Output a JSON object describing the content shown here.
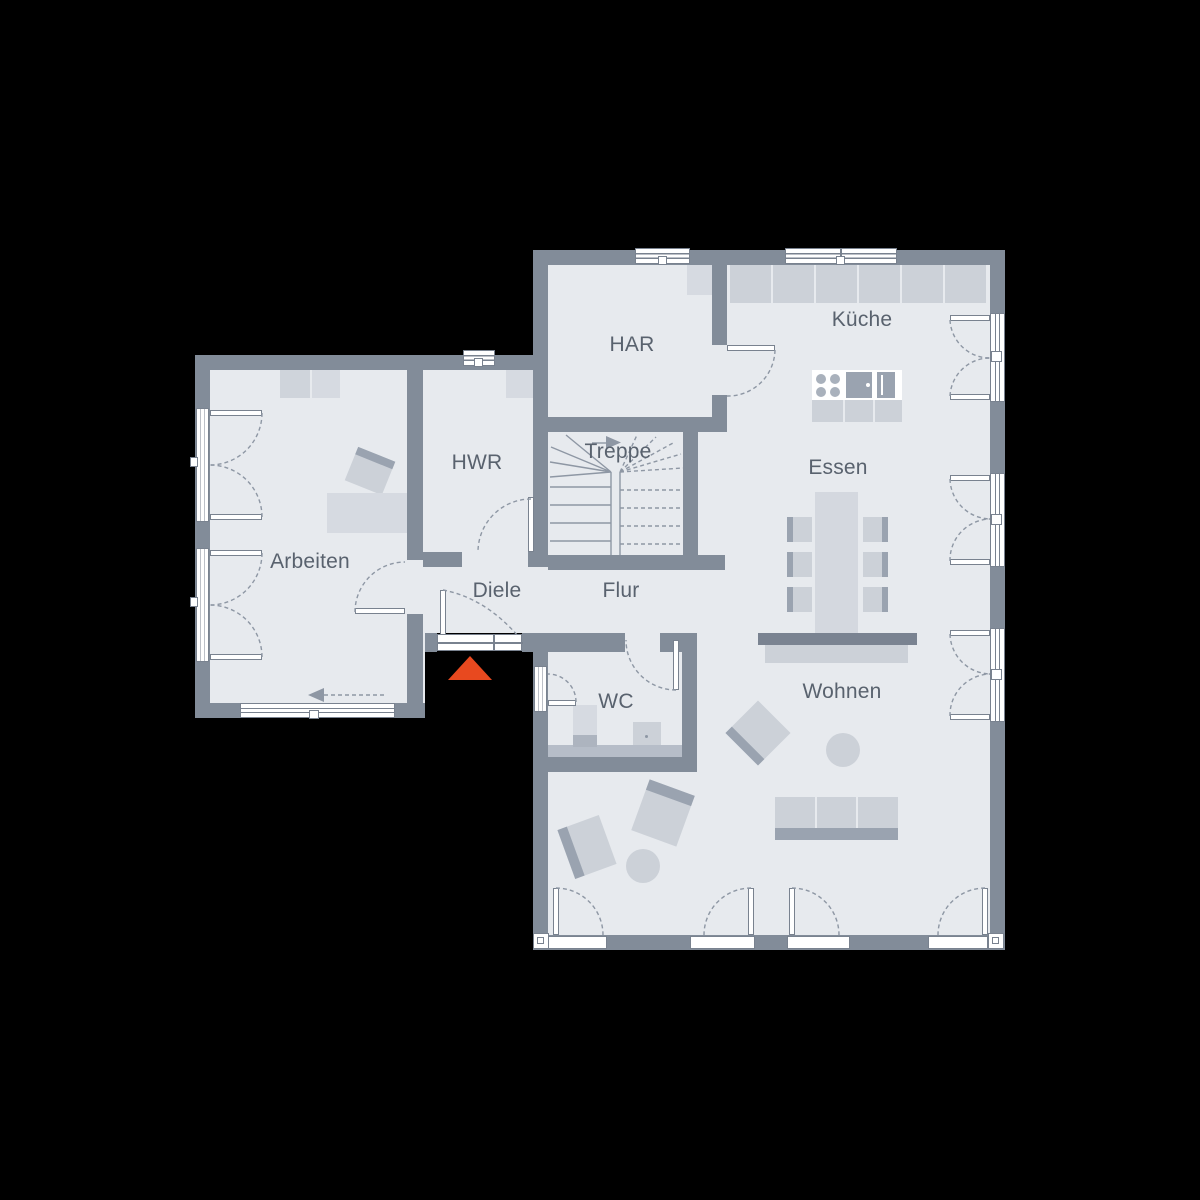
{
  "title": "Grundriss Erdgeschoss (floor plan)",
  "rooms": {
    "har": "HAR",
    "kueche": "Küche",
    "hwr": "HWR",
    "treppe": "Treppe",
    "essen": "Essen",
    "arbeiten": "Arbeiten",
    "diele": "Diele",
    "flur": "Flur",
    "wc": "WC",
    "wohnen": "Wohnen"
  },
  "icons": {
    "entrance_marker": "red-triangle-entrance",
    "stair_direction": "arrow-right",
    "walk_direction": "arrow-left-dashed"
  },
  "colors": {
    "background": "#000000",
    "wall": "#828C99",
    "floor": "#E7EAEE",
    "furniture-light": "#D6DAE1",
    "furniture-mid": "#CCD1D8",
    "furniture-dark": "#9AA3B0",
    "divider-dark": "#7A8391",
    "line": "#8E97A4",
    "frame": "#79828F",
    "label": "#59626E",
    "accent": "#E8491F",
    "shelf": "#B6BDC8",
    "fixture": "#ADB4BF"
  }
}
